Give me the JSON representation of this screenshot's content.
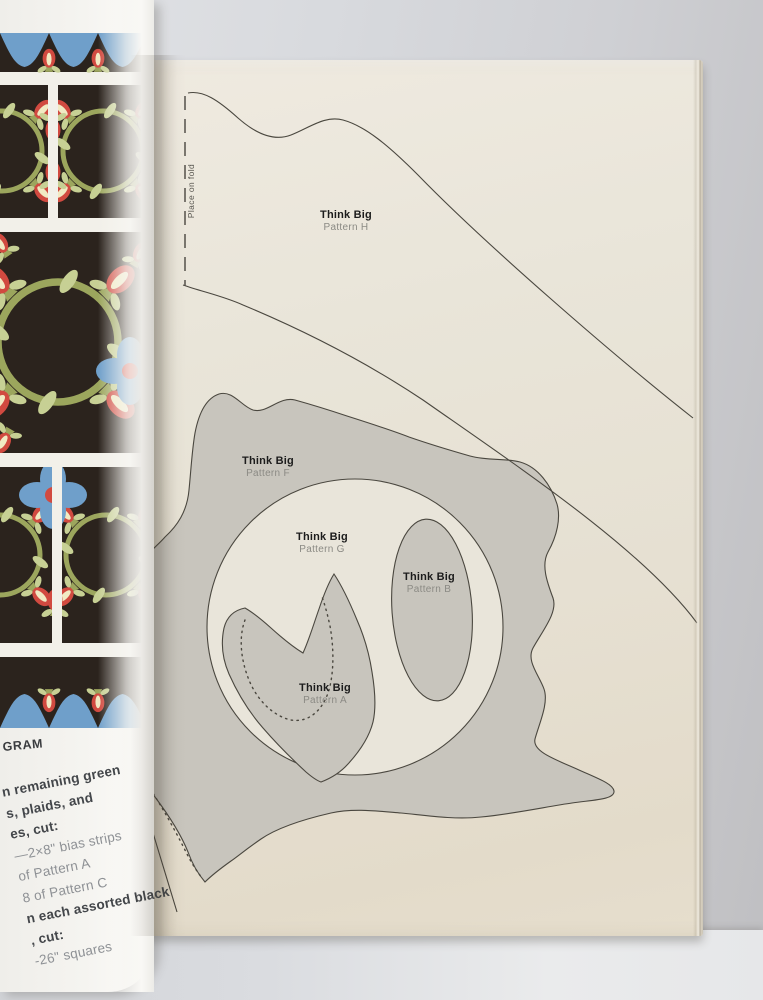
{
  "colors": {
    "pattern-gray": "#c8c5bd",
    "page-cream": "#e9e5da",
    "label-dark": "#1c1c1c",
    "label-gray": "#8b8a84",
    "text-gray": "#8e9195",
    "text-dark": "#43464a",
    "quilt-bg": "#2b231d",
    "quilt-red": "#d14a40",
    "quilt-cream": "#f1eac3",
    "quilt-olive": "#9ca65d",
    "quilt-leaf": "#c7d094",
    "quilt-blue": "#6f9fca",
    "quilt-sash": "#f2f0e9"
  },
  "left_page": {
    "heading_fragment": "GRAM",
    "instructions": [
      "n remaining green",
      "s, plaids, and",
      "es, cut:",
      "—2×8\" bias strips",
      "of Pattern A",
      "8 of Pattern C",
      "n each assorted black",
      ", cut:",
      "-26\" squares"
    ]
  },
  "right_page": {
    "fold_label": "Place on fold",
    "labels": {
      "h": {
        "title": "Think Big",
        "subtitle": "Pattern H"
      },
      "f": {
        "title": "Think Big",
        "subtitle": "Pattern F"
      },
      "g": {
        "title": "Think Big",
        "subtitle": "Pattern G"
      },
      "b": {
        "title": "Think Big",
        "subtitle": "Pattern B"
      },
      "a": {
        "title": "Think Big",
        "subtitle": "Pattern A"
      }
    },
    "gutter_fragments": [
      "Fo",
      "pl",
      "Fo",
      "an",
      "bu",
      "Fo",
      "pa",
      "m",
      "cu",
      "sq",
      "e"
    ]
  }
}
